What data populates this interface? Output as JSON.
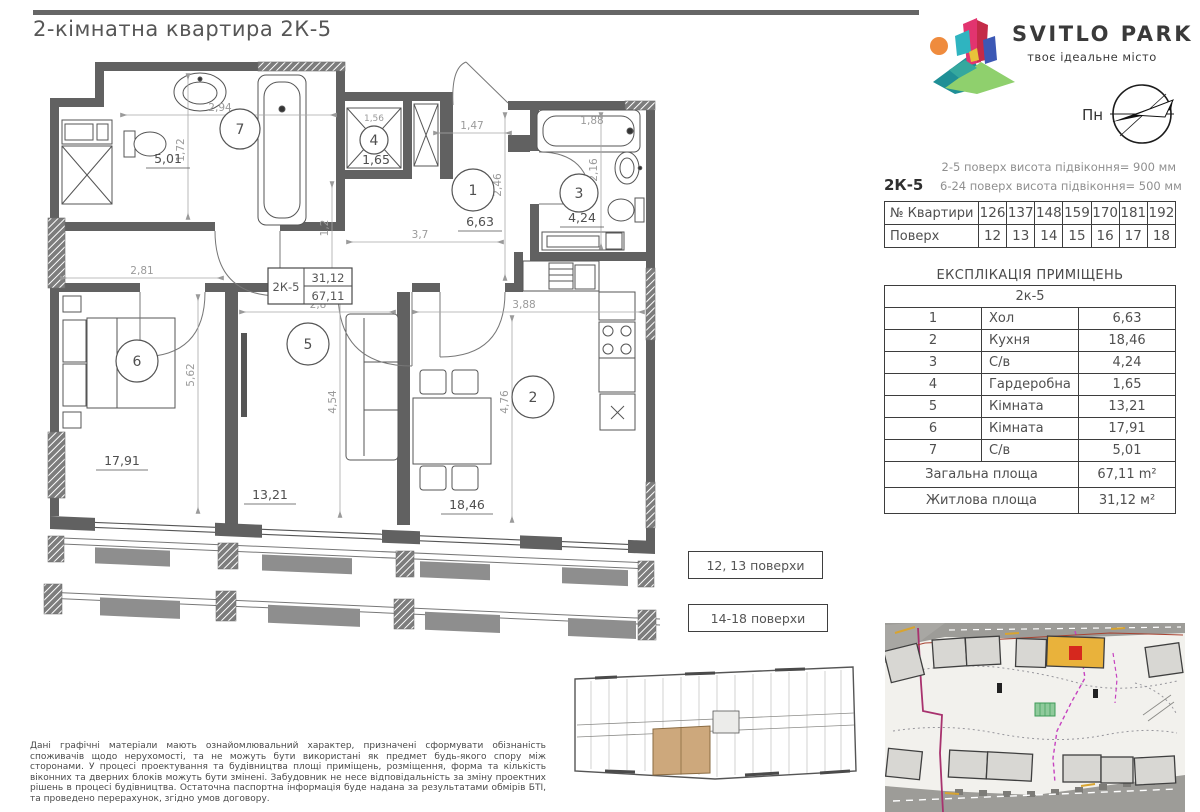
{
  "title": "2-кімнатна квартира 2К-5",
  "logo": {
    "name": "SVITLO PARK",
    "tagline": "твоє ідеальне місто"
  },
  "compass": {
    "label": "Пн"
  },
  "info": {
    "unit": "2К-5",
    "sill_note_1": "2-5 поверх висота підвіконня= 900 мм",
    "sill_note_2": "6-24 поверх висота підвіконня= 500 мм",
    "apartments_row_label": "№ Квартири",
    "apartments": [
      "126",
      "137",
      "148",
      "159",
      "170",
      "181",
      "192"
    ],
    "floors_row_label": "Поверх",
    "floors": [
      "12",
      "13",
      "14",
      "15",
      "16",
      "17",
      "18"
    ]
  },
  "explication": {
    "title": "ЕКСПЛІКАЦІЯ ПРИМІЩЕНЬ",
    "unit_header": "2к-5",
    "rows": [
      {
        "num": "1",
        "name": "Хол",
        "area": "6,63"
      },
      {
        "num": "2",
        "name": "Кухня",
        "area": "18,46"
      },
      {
        "num": "3",
        "name": "С/в",
        "area": "4,24"
      },
      {
        "num": "4",
        "name": "Гардеробна",
        "area": "1,65"
      },
      {
        "num": "5",
        "name": "Кімната",
        "area": "13,21"
      },
      {
        "num": "6",
        "name": "Кімната",
        "area": "17,91"
      },
      {
        "num": "7",
        "name": "С/в",
        "area": "5,01"
      }
    ],
    "total_label": "Загальна площа",
    "total_value": "67,11 m²",
    "living_label": "Житлова площа",
    "living_value": "31,12 м²"
  },
  "plan": {
    "stamp_unit": "2К-5",
    "stamp_living": "31,12",
    "stamp_total": "67,11",
    "r1": "1",
    "a1": "6,63",
    "r2": "2",
    "a2": "18,46",
    "r3": "3",
    "a3": "4,24",
    "r4": "4",
    "a4": "1,65",
    "r5": "5",
    "a5": "13,21",
    "r6": "6",
    "a6": "17,91",
    "r7": "7",
    "a7": "5,01",
    "d294": "2,94",
    "d172": "1,72",
    "d156": "1,56",
    "d12": "1,2",
    "d147": "1,47",
    "d246": "2,46",
    "d37": "3,7",
    "d188": "1,88",
    "d216": "2,16",
    "d281": "2,81",
    "d562": "5,62",
    "d28": "2,8",
    "d454": "4,54",
    "d388": "3,88",
    "d476": "4,76"
  },
  "floor_labels": {
    "first": "12, 13 поверхи",
    "second": "14-18 поверхи"
  },
  "disclaimer": "Дані графічні матеріали мають ознайомлювальний характер, призначені сформувати обізнаність споживачів щодо нерухомості, та не можуть бути використані як предмет будь-якого спору між сторонами. У процесі проектування та будівництва площі приміщень, розміщення, форма та кількість віконних та дверних блоків можуть бути змінені. Забудовник не несе відповідальність за зміну проектних рішень в процесі будівництва. Остаточна паспортна інформація буде надана за результатами обмірів БТІ, та проведено перерахунок, згідно умов договору.",
  "colors": {
    "wall": "#616161",
    "accent_yellow": "#e9b23b",
    "accent_red": "#d6281e",
    "highlight_tan": "#cda87c",
    "magenta": "#b03a8c"
  }
}
